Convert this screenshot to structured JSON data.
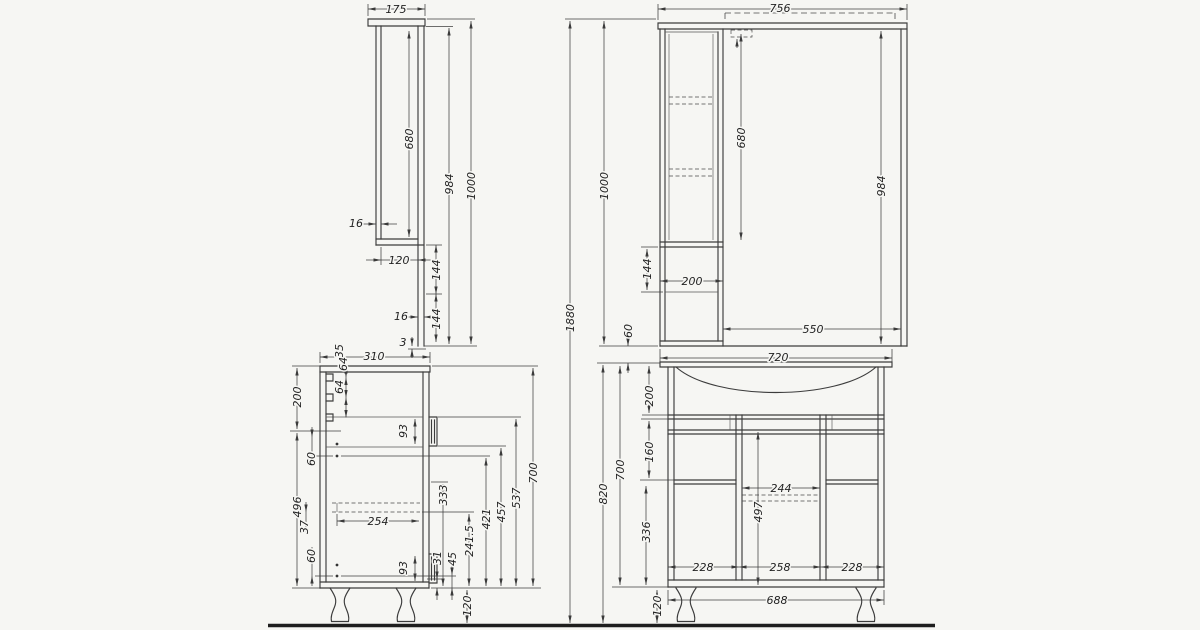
{
  "drawing": {
    "colors": {
      "ink": "#3c3c3c",
      "paper": "#f6f6f3"
    },
    "dimensions": [
      {
        "name": "mirror-side-top-depth",
        "text": "175",
        "x": 396,
        "y": 13,
        "rot": 0
      },
      {
        "name": "mirror-side-door-height",
        "text": "680",
        "x": 413,
        "y": 139,
        "rot": 1
      },
      {
        "name": "mirror-side-under-top-height",
        "text": "984",
        "x": 453,
        "y": 184,
        "rot": 1
      },
      {
        "name": "mirror-side-overall-height",
        "text": "1000",
        "x": 475,
        "y": 186,
        "rot": 1
      },
      {
        "name": "mirror-side-panel-thickness-upper",
        "text": "16",
        "x": 356,
        "y": 227,
        "rot": 0
      },
      {
        "name": "mirror-side-lower-depth",
        "text": "120",
        "x": 399,
        "y": 264,
        "rot": 0
      },
      {
        "name": "mirror-side-offset-a",
        "text": "144",
        "x": 440,
        "y": 270,
        "rot": 1
      },
      {
        "name": "mirror-side-panel-thickness-lower",
        "text": "16",
        "x": 401,
        "y": 320,
        "rot": 0
      },
      {
        "name": "mirror-side-offset-b",
        "text": "144",
        "x": 440,
        "y": 319,
        "rot": 1
      },
      {
        "name": "mirror-side-bottom-gap",
        "text": "3",
        "x": 403,
        "y": 346,
        "rot": 0
      },
      {
        "name": "mirror-front-overall-width",
        "text": "756",
        "x": 780,
        "y": 12,
        "rot": 0
      },
      {
        "name": "mirror-front-overall-height",
        "text": "1000",
        "x": 608,
        "y": 186,
        "rot": 1
      },
      {
        "name": "mirror-front-door-height",
        "text": "680",
        "x": 745,
        "y": 138,
        "rot": 1
      },
      {
        "name": "mirror-front-under-top-height",
        "text": "984",
        "x": 885,
        "y": 186,
        "rot": 1
      },
      {
        "name": "mirror-front-lower-offset",
        "text": "144",
        "x": 651,
        "y": 269,
        "rot": 1
      },
      {
        "name": "mirror-front-column-width",
        "text": "200",
        "x": 692,
        "y": 285,
        "rot": 0
      },
      {
        "name": "mirror-front-mirror-width",
        "text": "550",
        "x": 813,
        "y": 333,
        "rot": 0
      },
      {
        "name": "mirror-front-gap",
        "text": "60",
        "x": 632,
        "y": 331,
        "rot": 1
      },
      {
        "name": "overall-height",
        "text": "1880",
        "x": 574,
        "y": 318,
        "rot": 1
      },
      {
        "name": "vanity-side-depth",
        "text": "310",
        "x": 374,
        "y": 360,
        "rot": 0
      },
      {
        "name": "vanity-side-chain-35",
        "text": "35",
        "x": 343,
        "y": 351,
        "rot": 1
      },
      {
        "name": "vanity-side-chain-64a",
        "text": "64",
        "x": 347,
        "y": 364,
        "rot": 1
      },
      {
        "name": "vanity-side-chain-64b",
        "text": "64",
        "x": 343,
        "y": 387,
        "rot": 1
      },
      {
        "name": "vanity-side-upper-200",
        "text": "200",
        "x": 301,
        "y": 397,
        "rot": 1
      },
      {
        "name": "vanity-side-holes-60a",
        "text": "60",
        "x": 315,
        "y": 459,
        "rot": 1
      },
      {
        "name": "vanity-side-lower-496",
        "text": "496",
        "x": 301,
        "y": 507,
        "rot": 1
      },
      {
        "name": "vanity-side-offset-37",
        "text": "37",
        "x": 308,
        "y": 527,
        "rot": 1
      },
      {
        "name": "vanity-side-holes-60b",
        "text": "60",
        "x": 315,
        "y": 556,
        "rot": 1
      },
      {
        "name": "vanity-side-drawer-depth",
        "text": "254",
        "x": 378,
        "y": 525,
        "rot": 0
      },
      {
        "name": "vanity-side-handle-upper",
        "text": "93",
        "x": 407,
        "y": 431,
        "rot": 1
      },
      {
        "name": "vanity-side-handle-lower",
        "text": "93",
        "x": 407,
        "y": 568,
        "rot": 1
      },
      {
        "name": "vanity-side-333",
        "text": "333",
        "x": 447,
        "y": 495,
        "rot": 1
      },
      {
        "name": "vanity-side-31",
        "text": "31",
        "x": 441,
        "y": 558,
        "rot": 1
      },
      {
        "name": "vanity-side-45",
        "text": "45",
        "x": 456,
        "y": 559,
        "rot": 1
      },
      {
        "name": "vanity-side-241-5",
        "text": "241.5",
        "x": 473,
        "y": 541,
        "rot": 1
      },
      {
        "name": "vanity-side-421",
        "text": "421",
        "x": 490,
        "y": 519,
        "rot": 1
      },
      {
        "name": "vanity-side-457",
        "text": "457",
        "x": 505,
        "y": 512,
        "rot": 1
      },
      {
        "name": "vanity-side-537",
        "text": "537",
        "x": 520,
        "y": 498,
        "rot": 1
      },
      {
        "name": "vanity-side-box-700",
        "text": "700",
        "x": 537,
        "y": 473,
        "rot": 1
      },
      {
        "name": "vanity-side-legs-120",
        "text": "120",
        "x": 471,
        "y": 606,
        "rot": 1
      },
      {
        "name": "vanity-front-basin-width",
        "text": "720",
        "x": 778,
        "y": 361,
        "rot": 0
      },
      {
        "name": "vanity-front-basin-200",
        "text": "200",
        "x": 653,
        "y": 396,
        "rot": 1
      },
      {
        "name": "vanity-front-mid-160",
        "text": "160",
        "x": 653,
        "y": 452,
        "rot": 1
      },
      {
        "name": "vanity-front-low-336",
        "text": "336",
        "x": 650,
        "y": 532,
        "rot": 1
      },
      {
        "name": "vanity-front-box-700",
        "text": "700",
        "x": 624,
        "y": 470,
        "rot": 1
      },
      {
        "name": "vanity-front-overall-820",
        "text": "820",
        "x": 607,
        "y": 494,
        "rot": 1
      },
      {
        "name": "vanity-front-center-244",
        "text": "244",
        "x": 781,
        "y": 492,
        "rot": 0
      },
      {
        "name": "vanity-front-center-497",
        "text": "497",
        "x": 762,
        "y": 512,
        "rot": 1
      },
      {
        "name": "vanity-front-section-228a",
        "text": "228",
        "x": 703,
        "y": 571,
        "rot": 0
      },
      {
        "name": "vanity-front-section-258",
        "text": "258",
        "x": 780,
        "y": 571,
        "rot": 0
      },
      {
        "name": "vanity-front-section-228b",
        "text": "228",
        "x": 852,
        "y": 571,
        "rot": 0
      },
      {
        "name": "vanity-front-carcass-688",
        "text": "688",
        "x": 777,
        "y": 604,
        "rot": 0
      },
      {
        "name": "vanity-front-legs-120",
        "text": "120",
        "x": 661,
        "y": 606,
        "rot": 1
      }
    ]
  }
}
